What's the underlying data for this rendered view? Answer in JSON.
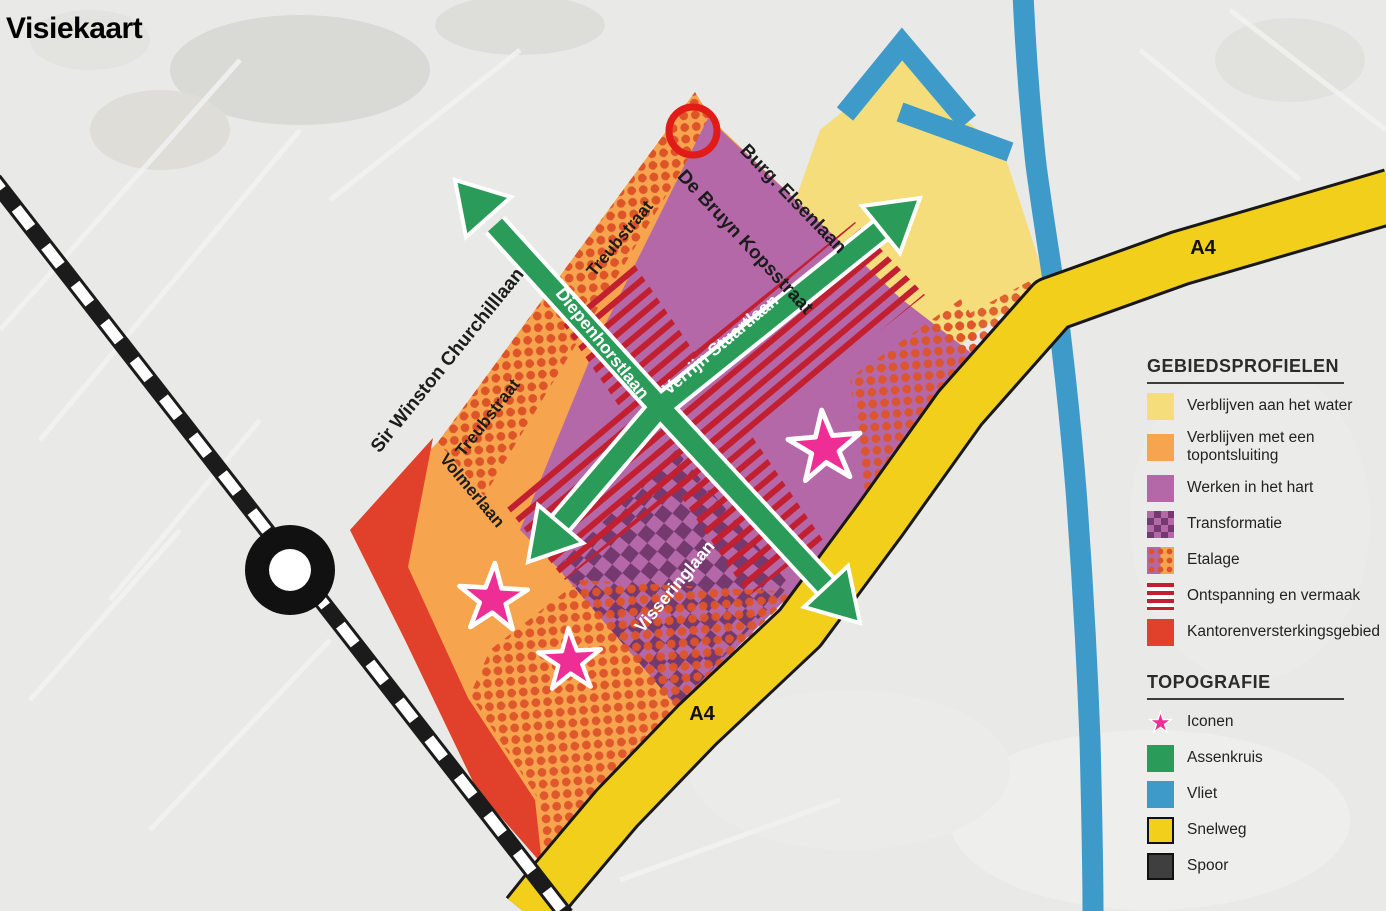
{
  "title": "Visiekaart",
  "map": {
    "streets": {
      "churchilllaan": "Sir Winston Churchilllaan",
      "treubstraat_upper": "Treubstraat",
      "treubstraat_lower": "Treubstraat",
      "volmerlaan": "Volmerlaan",
      "burg_elsenlaan": "Burg. Elsenlaan",
      "de_bruyn_kopsstraat": "De Bruyn Kopsstraat",
      "diepenhorstlaan": "Diepenhorstlaan",
      "verrijn_stuartlaan": "Verrijn Stuartlaan",
      "visseringlaan": "Visseringlaan"
    },
    "highway_labels": {
      "upper": "A4",
      "lower": "A4"
    }
  },
  "legend": {
    "sections": [
      {
        "title": "GEBIEDSPROFIELEN",
        "items": [
          {
            "label": "Verblijven aan het water",
            "swatch": "yellow"
          },
          {
            "label": "Verblijven met een topontsluiting",
            "swatch": "orange"
          },
          {
            "label": "Werken in het hart",
            "swatch": "purple"
          },
          {
            "label": "Transformatie",
            "swatch": "checker"
          },
          {
            "label": "Etalage",
            "swatch": "etalage"
          },
          {
            "label": "Ontspanning en vermaak",
            "swatch": "stripes"
          },
          {
            "label": "Kantorenversterkingsgebied",
            "swatch": "red"
          }
        ]
      },
      {
        "title": "TOPOGRAFIE",
        "items": [
          {
            "label": "Iconen",
            "swatch": "star"
          },
          {
            "label": "Assenkruis",
            "swatch": "green"
          },
          {
            "label": "Vliet",
            "swatch": "blue"
          },
          {
            "label": "Snelweg",
            "swatch": "snelweg"
          },
          {
            "label": "Spoor",
            "swatch": "spoor"
          }
        ]
      }
    ]
  },
  "colors": {
    "background": "#e9e9e7",
    "verblijven_water": "#f4dd7a",
    "verblijven_topontsluiting": "#f6a44e",
    "werken_hart": "#b568a8",
    "transformatie_dark": "#743a70",
    "etalage_dot": "#dd5429",
    "ontspanning_stripe": "#c22030",
    "kantorenversterking": "#e1402a",
    "assenkruis": "#2b9b59",
    "vliet": "#3e9ac9",
    "snelweg": "#f2cf1b",
    "spoor": "#2a2a2a",
    "icoon": "#ee2e95",
    "annotation_circle": "#e11b17"
  }
}
